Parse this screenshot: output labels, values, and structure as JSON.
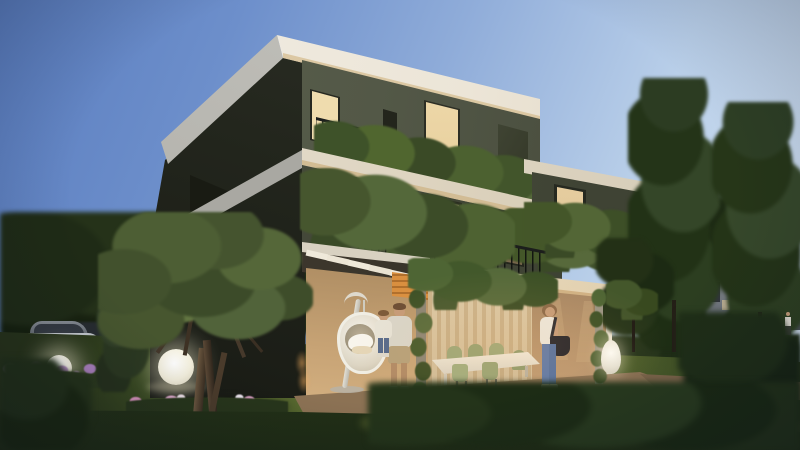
{
  "scene": {
    "description": "Dusk architectural rendering of a modern three-storey villa with stacked white roof slabs, olive-green walls, planted balconies with black railings, a warmly lit ground-floor patio with pergola, dining set, hanging egg chair, a man holding a child, a woman with a bag, garden with olive tree, glowing sphere lamps, parked car and tall trees",
    "time_of_day": "dusk",
    "objects": [
      "dusk-sky",
      "modern-villa",
      "roof-slab",
      "balcony-railing",
      "balcony-plants",
      "lit-window",
      "curtain-glass-door",
      "pergola",
      "vine-column",
      "patio",
      "dining-set",
      "hanging-egg-chair",
      "man-holding-child",
      "woman-with-bag",
      "olive-tree",
      "glow-sphere-lamp",
      "teardrop-floor-lamp",
      "flower-bed",
      "lawn",
      "hedge",
      "parked-car",
      "distant-house",
      "tall-trees"
    ]
  },
  "palette": {
    "sky_top": "#5a7dbf",
    "sky_mid": "#8facd9",
    "sky_horizon": "#d7e5f4",
    "slab_white": "#f2efe7",
    "slab_warm": "#e0cfae",
    "slab_shadow": "#a9a8a2",
    "wall_olive": "#535847",
    "wall_olive_dark": "#3a3e30",
    "wall_side_dark": "#23261d",
    "wall_cream": "#d9b88c",
    "wall_cream_shadow": "#6e5943",
    "window_glow": "#f2dfb2",
    "window_dark": "#23251c",
    "railing_black": "#1c1e1c",
    "plant_dark": "#3a4a26",
    "plant_mid": "#4e6232",
    "plant_light": "#6d8243",
    "tree_dark": "#22301a",
    "lawn_lit": "#6d7d3a",
    "lawn_dark": "#273319",
    "patio_lit": "#eed4a9",
    "patio_shadow": "#8c7254",
    "flower_pink": "#d791bb",
    "flower_lavender": "#b48cc8",
    "car_silver": "#b7bdc3",
    "orange_accent": "#d98f3f",
    "jeans_blue": "#5d78a8",
    "skin": "#c59b78",
    "bag_black": "#23232a",
    "roof_distant": "#453d52",
    "path_tan": "#b79b78",
    "sphere_white": "#ffffff"
  }
}
